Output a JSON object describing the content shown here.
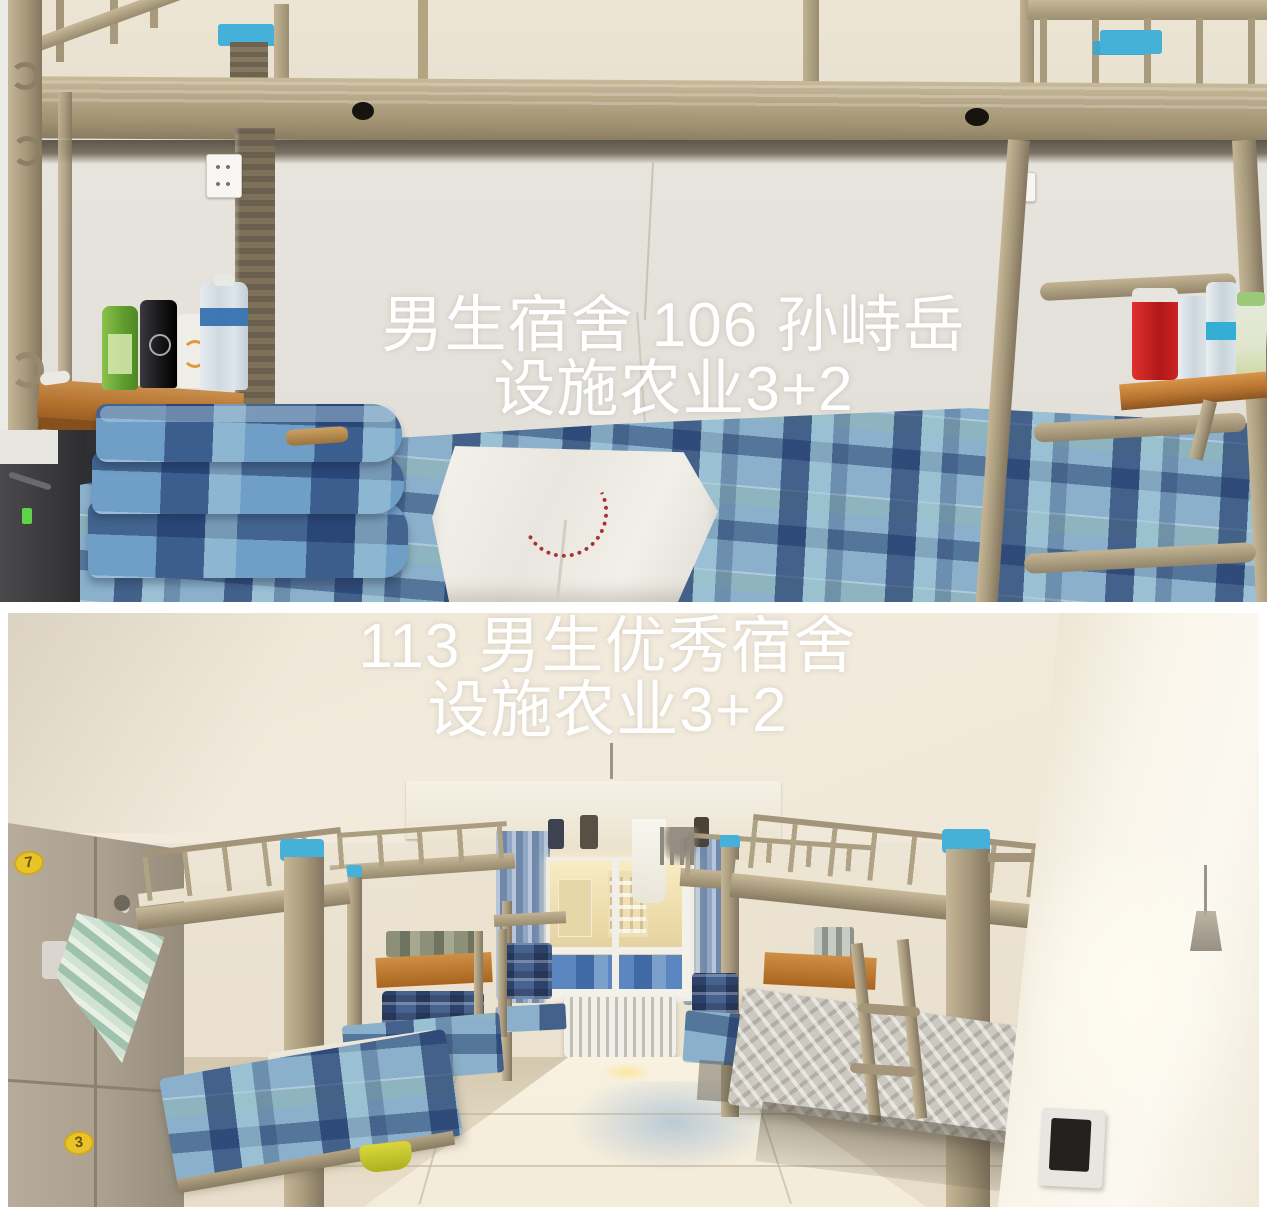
{
  "canvas": {
    "width": 1267,
    "height": 1217,
    "background": "#ffffff"
  },
  "top_photo": {
    "overlay_line1": "男生宿舍 106 孙峙岳",
    "overlay_line2": "设施农业3+2",
    "overlay_color": "#ffffff",
    "palette": {
      "bed_frame_khaki": "#a89a7c",
      "wall": "#e6e2db",
      "bedding_blue": "#8ab0cb",
      "bedding_navy": "#31507e",
      "desk_wood": "#b5722f",
      "hook_blue": "#45b1d8",
      "towel_white": "#f2efe9",
      "embroidery_red": "#a63434"
    }
  },
  "bottom_photo": {
    "overlay_line1": "113 男生优秀宿舍",
    "overlay_line2": "设施农业3+2",
    "overlay_color": "#ffffff",
    "locker_sticker_top": "7",
    "locker_sticker_bottom": "3",
    "palette": {
      "ceiling": "#f0e9dc",
      "floor": "#d9cdb8",
      "bright_wall": "#f9f5ec",
      "curtain_blue": "#8fa6c4",
      "radiator": "#e9e6de",
      "locker": "#ab9f8e",
      "sticker_yellow": "#e8c428",
      "bed_frame_khaki": "#a89a7c"
    }
  }
}
